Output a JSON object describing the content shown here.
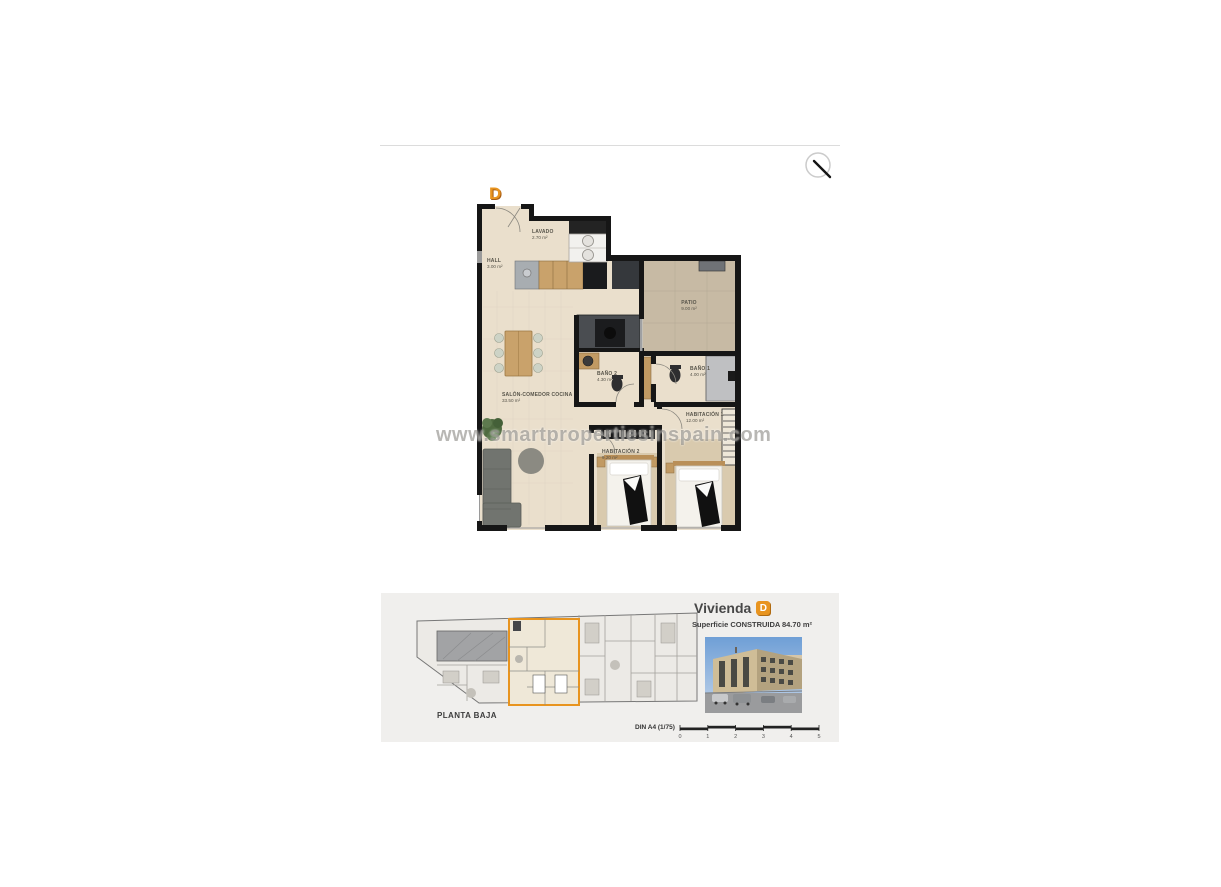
{
  "gallery": {
    "zoom_icon": "magnifier"
  },
  "floorplan": {
    "unit_letter": "D",
    "accent_color": "#E8941F",
    "watermark": "www.smartpropertiesinspain.com",
    "rooms": [
      {
        "name": "HALL",
        "area": "3.00 m²"
      },
      {
        "name": "LAVADO",
        "area": "2.70 m²"
      },
      {
        "name": "PATIO",
        "area": "9.00 m²"
      },
      {
        "name": "BAÑO 2",
        "area": "4.30 m²"
      },
      {
        "name": "BAÑO 1",
        "area": "4.00 m²"
      },
      {
        "name": "SALÓN-COMEDOR COCINA",
        "area": "33.50 m²"
      },
      {
        "name": "HABITACIÓN 2",
        "area": "9.20 m²"
      },
      {
        "name": "HABITACIÓN 1",
        "area": "12.00 m²"
      }
    ]
  },
  "info_panel": {
    "site_plan_label": "PLANTA BAJA",
    "unit_title": "Vivienda",
    "unit_letter": "D",
    "surface_label": "Superficie CONSTRUIDA",
    "surface_value": "84.70 m²",
    "scale_label": "DIN A4 (1/75)",
    "scale_ticks": [
      "0",
      "1",
      "2",
      "3",
      "4",
      "5"
    ]
  }
}
